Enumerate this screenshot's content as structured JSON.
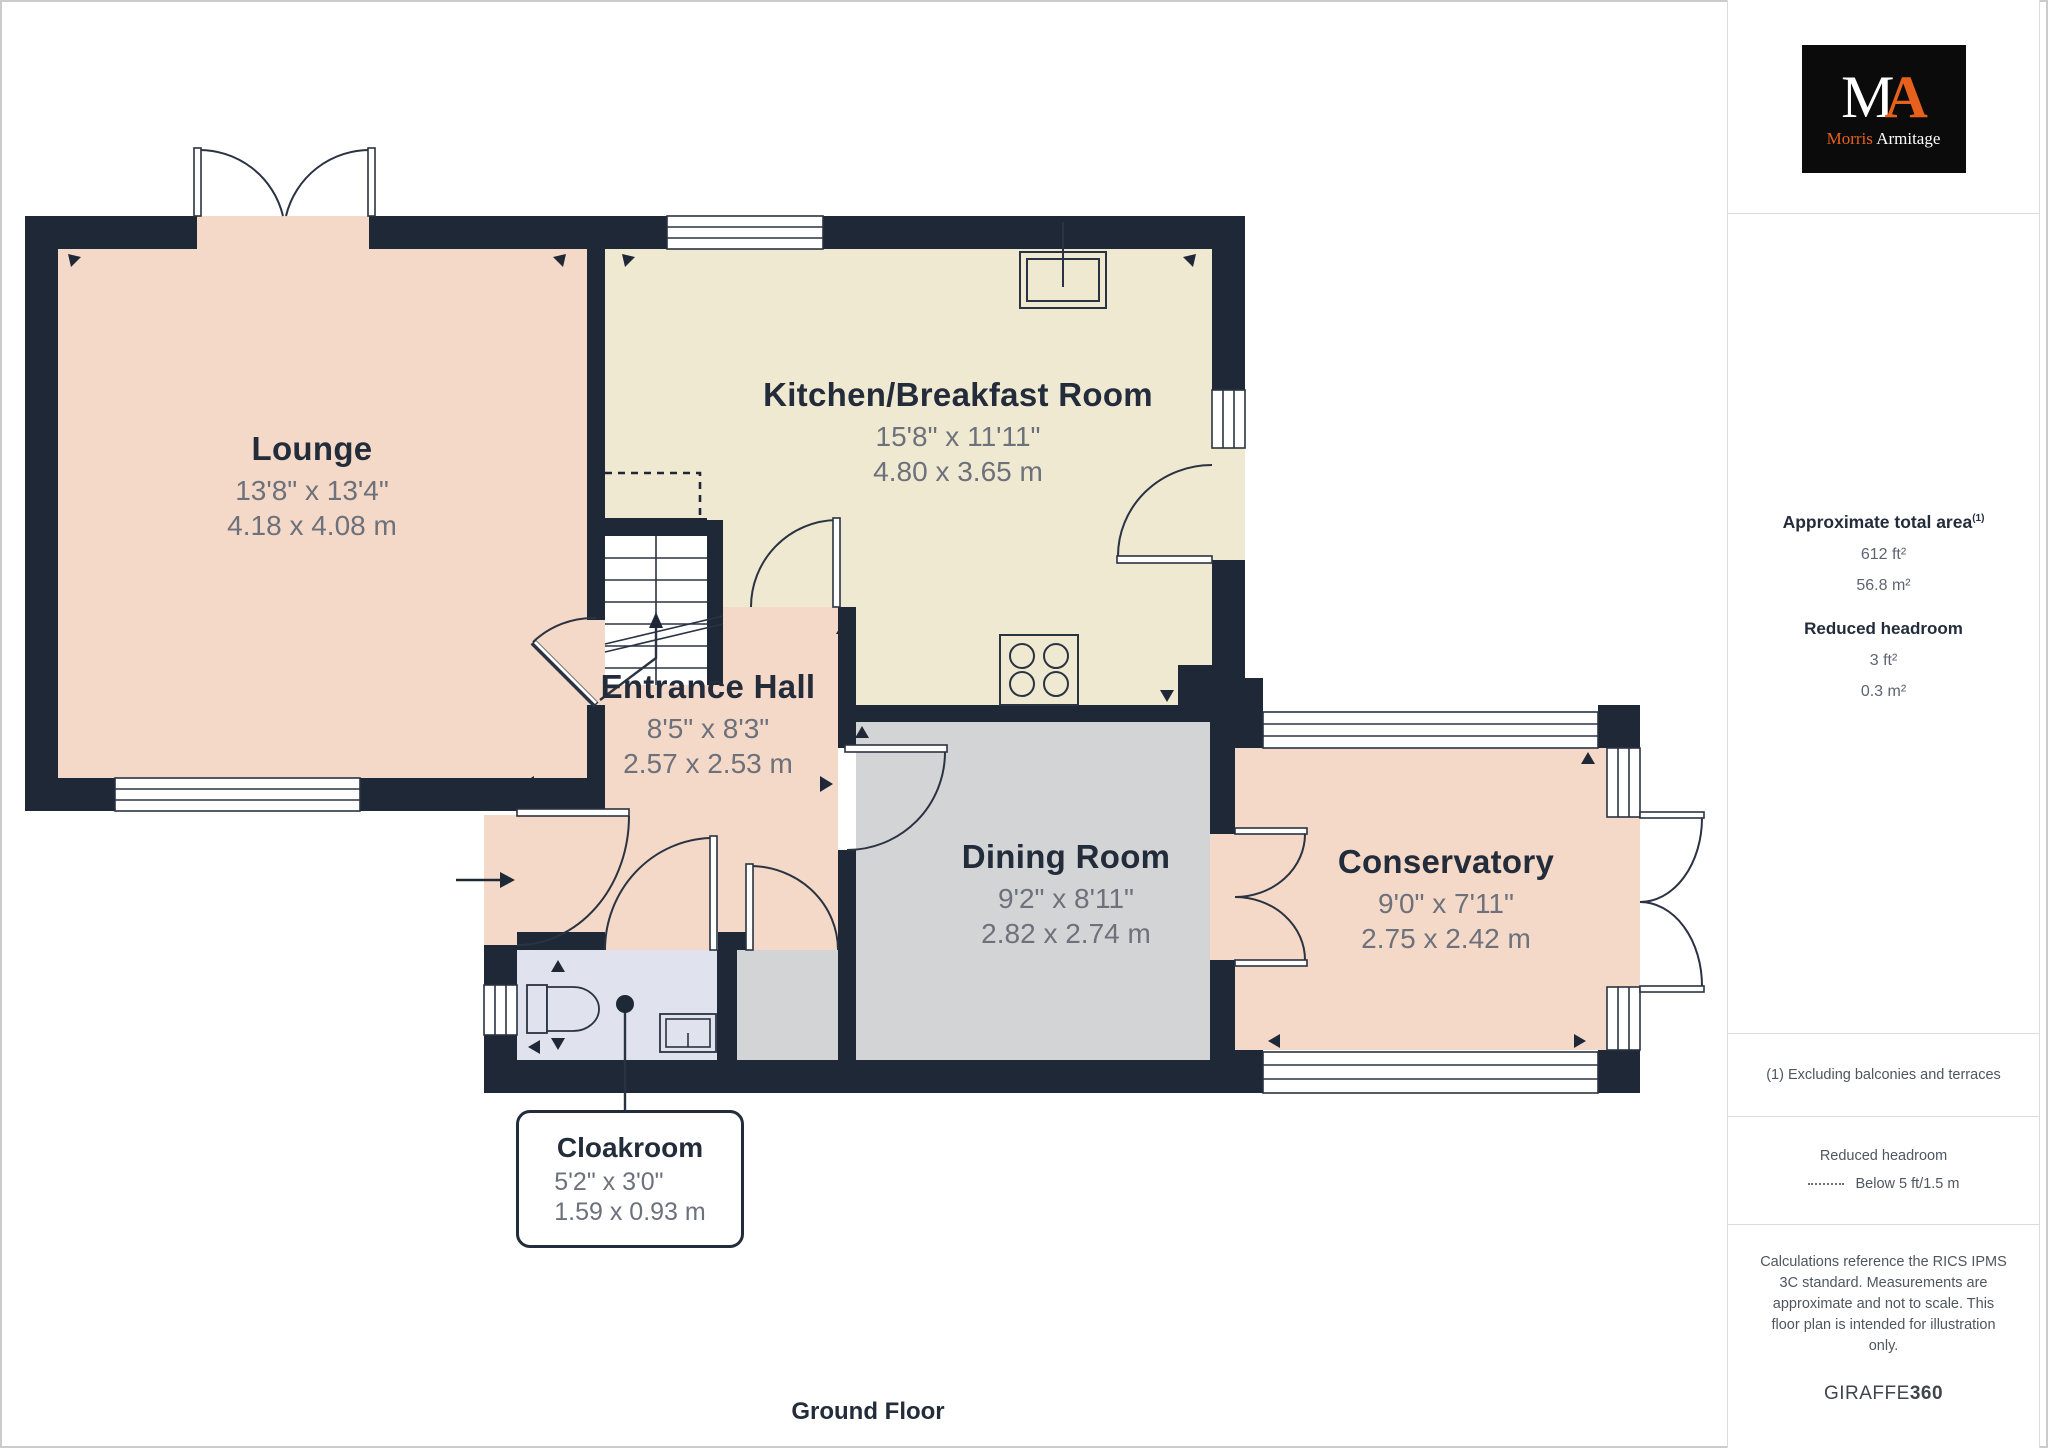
{
  "logo": {
    "monogram_m": "M",
    "monogram_a": "A",
    "name_first": "Morris",
    "name_last": "Armitage",
    "bg": "#0b0b0b",
    "orange": "#e8611c"
  },
  "sidebar": {
    "area": {
      "title": "Approximate total area",
      "superscript": "(1)",
      "value_ft": "612 ft²",
      "value_m": "56.8 m²"
    },
    "reduced_headroom": {
      "title": "Reduced headroom",
      "value_ft": "3 ft²",
      "value_m": "0.3 m²"
    },
    "footnote": "(1) Excluding balconies and terraces",
    "legend": {
      "title": "Reduced headroom",
      "item": "Below 5 ft/1.5 m"
    },
    "disclaimer": "Calculations reference the RICS IPMS 3C standard. Measurements are approximate and not to scale. This floor plan is intended for illustration only.",
    "brand_name": "GIRAFFE",
    "brand_suffix": "360"
  },
  "plan": {
    "floor_label": "Ground Floor",
    "rooms": [
      {
        "name": "Lounge",
        "imperial": "13'8\" x 13'4\"",
        "metric": "4.18 x 4.08 m"
      },
      {
        "name": "Kitchen/Breakfast Room",
        "imperial": "15'8\" x 11'11\"",
        "metric": "4.80 x 3.65 m"
      },
      {
        "name": "Entrance Hall",
        "imperial": "8'5\" x 8'3\"",
        "metric": "2.57 x 2.53 m"
      },
      {
        "name": "Dining Room",
        "imperial": "9'2\" x 8'11\"",
        "metric": "2.82 x 2.74 m"
      },
      {
        "name": "Conservatory",
        "imperial": "9'0\" x 7'11\"",
        "metric": "2.75 x 2.42 m"
      },
      {
        "name": "Cloakroom",
        "imperial": "5'2\" x 3'0\"",
        "metric": "1.59 x 0.93 m"
      }
    ],
    "colors": {
      "wall": "#1f2836",
      "line": "#2a3342",
      "lounge_hall_conservatory": "#f5d9c8",
      "kitchen": "#f0e9d2",
      "dining": "#d3d4d6",
      "cloakroom": "#e0e3ee",
      "label_text": "#232c3a",
      "dimension_text": "#6c717b"
    }
  }
}
